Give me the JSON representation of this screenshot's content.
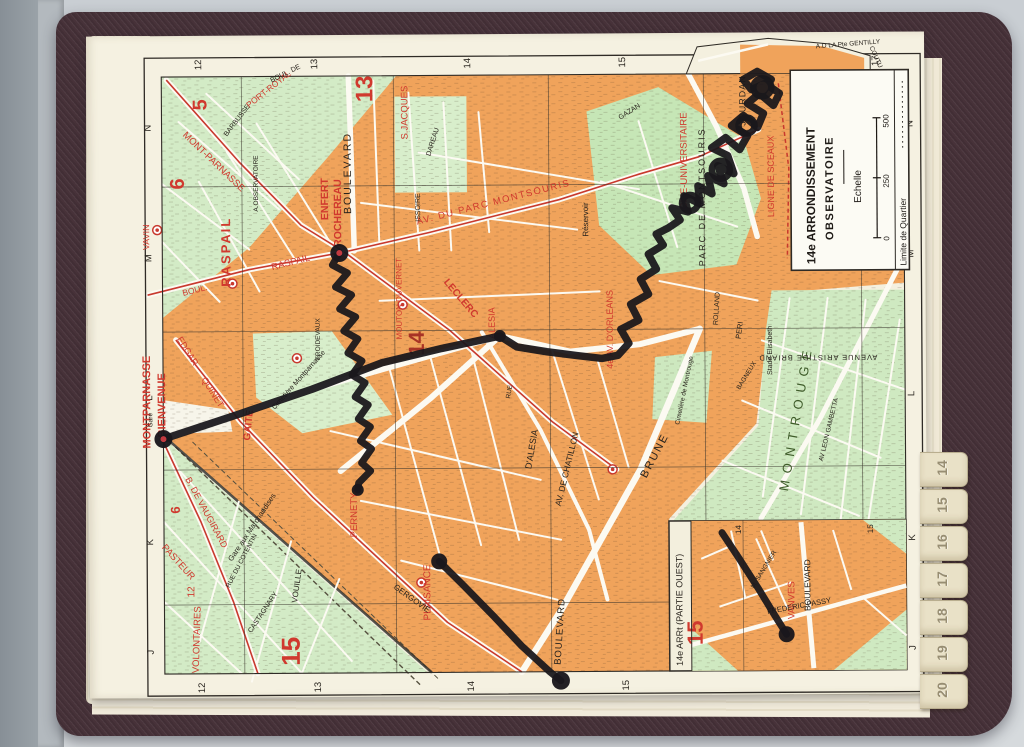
{
  "colors": {
    "accent_red": "#d0392e",
    "block_orange": "#f0a35b",
    "area_green": "#d3ebc6",
    "park_green": "#c6e6b6",
    "route_black": "#1a171c",
    "cover_maroon": "#473239",
    "paper_cream": "#f5f1e1",
    "tab_cream": "#e9e1c7"
  },
  "legend": {
    "l1": "14e ARRONDISSEMENT",
    "l2": "OBSERVATOIRE",
    "echelle": "Echelle",
    "t0": "0",
    "t250": "250",
    "t500": "500",
    "limite": "Limite de Quartier"
  },
  "tabs": [
    "14",
    "15",
    "16",
    "17",
    "18",
    "19",
    "20"
  ],
  "map": {
    "inset_title": "14e ARRt (PARTIE OUEST)",
    "grid": {
      "cols": [
        "12",
        "13",
        "14",
        "15",
        "16",
        "17"
      ],
      "colX": [
        203,
        319,
        472,
        627,
        788,
        880
      ],
      "colLineX": [
        243,
        395,
        550,
        705,
        862
      ],
      "rows": [
        "N",
        "M",
        "L",
        "K",
        "J"
      ],
      "rowY": [
        126,
        256,
        396,
        540,
        650
      ],
      "rowLineY": [
        185,
        330,
        468,
        603
      ],
      "insetCols": [
        "14",
        "15"
      ],
      "insetColX": [
        740,
        872
      ]
    },
    "labels": [
      {
        "t": "MONTPARNASSE",
        "x": 150,
        "y": 400,
        "r": -90,
        "s": 11,
        "c": "r",
        "b": 1
      },
      {
        "t": "-BIENVENUE",
        "x": 165,
        "y": 405,
        "r": -90,
        "s": 11,
        "c": "r",
        "b": 1
      },
      {
        "t": "Gare",
        "x": 152,
        "y": 418,
        "r": -90,
        "s": 6.5,
        "c": "k"
      },
      {
        "t": "VAVIN",
        "x": 150,
        "y": 235,
        "r": -90,
        "s": 9,
        "c": "r"
      },
      {
        "t": "RASPAIL",
        "x": 231,
        "y": 250,
        "r": -90,
        "s": 13,
        "c": "r",
        "b": 1,
        "ls": 2
      },
      {
        "t": "BOUL.",
        "x": 196,
        "y": 291,
        "r": -14,
        "s": 8.5,
        "c": "r"
      },
      {
        "t": "RASPAIL",
        "x": 292,
        "y": 264,
        "r": -14,
        "s": 9.5,
        "c": "r"
      },
      {
        "t": "MONT-PARNASSE",
        "x": 213,
        "y": 162,
        "r": 44,
        "s": 9.5,
        "c": "r"
      },
      {
        "t": "PORT-ROYAL",
        "x": 272,
        "y": 90,
        "r": -38,
        "s": 8.5,
        "c": "r"
      },
      {
        "t": "EDGAR-",
        "x": 186,
        "y": 352,
        "r": 58,
        "s": 9,
        "c": "r"
      },
      {
        "t": "QUINET",
        "x": 210,
        "y": 392,
        "r": 58,
        "s": 9,
        "c": "r"
      },
      {
        "t": "GAITE",
        "x": 251,
        "y": 424,
        "r": -84,
        "s": 10,
        "c": "r",
        "b": 1
      },
      {
        "t": "PERNETY",
        "x": 356,
        "y": 514,
        "r": -90,
        "s": 9.5,
        "c": "r"
      },
      {
        "t": "PLAISANCE",
        "x": 429,
        "y": 592,
        "r": -90,
        "s": 10,
        "c": "r"
      },
      {
        "t": "B. DE VAUGIRARD",
        "x": 203,
        "y": 512,
        "r": 62,
        "s": 9,
        "c": "r"
      },
      {
        "t": "PASTEUR",
        "x": 175,
        "y": 562,
        "r": 48,
        "s": 9.5,
        "c": "r"
      },
      {
        "t": "VOLONTAIRES",
        "x": 198,
        "y": 638,
        "r": -88,
        "s": 9.5,
        "c": "r"
      },
      {
        "t": "12",
        "x": 193,
        "y": 590,
        "r": -90,
        "s": 10,
        "c": "r"
      },
      {
        "t": "ENFERT",
        "x": 329,
        "y": 198,
        "r": -90,
        "s": 10.5,
        "c": "r",
        "b": 1
      },
      {
        "t": "ROCHEREAU",
        "x": 342,
        "y": 212,
        "r": -90,
        "s": 10.5,
        "c": "r",
        "b": 1
      },
      {
        "t": "S.JACQUES",
        "x": 409,
        "y": 112,
        "r": -90,
        "s": 9.5,
        "c": "r"
      },
      {
        "t": "AV. DU PARC MONTSOURIS",
        "x": 495,
        "y": 205,
        "r": -14,
        "s": 9.5,
        "c": "r",
        "ls": 1.5
      },
      {
        "t": "MOUTON DUVERNET",
        "x": 402,
        "y": 298,
        "r": -90,
        "s": 8,
        "c": "r"
      },
      {
        "t": "LECLERC",
        "x": 459,
        "y": 300,
        "r": 50,
        "s": 10,
        "c": "r",
        "b": 1
      },
      {
        "t": "4e AV. D'ORLEANS",
        "x": 613,
        "y": 330,
        "r": -90,
        "s": 9,
        "c": "r"
      },
      {
        "t": "ALESIA",
        "x": 495,
        "y": 323,
        "r": -90,
        "s": 9,
        "c": "r"
      },
      {
        "t": "CITE-UNIVERSITAIRE",
        "x": 688,
        "y": 162,
        "r": -90,
        "s": 9.5,
        "c": "r"
      },
      {
        "t": "LIGNE DE SCEAUX",
        "x": 775,
        "y": 178,
        "r": -90,
        "s": 9,
        "c": "r"
      },
      {
        "t": "VANVES",
        "x": 793,
        "y": 602,
        "r": -90,
        "s": 9.5,
        "c": "r"
      },
      {
        "t": "5",
        "x": 208,
        "y": 103,
        "r": -90,
        "s": 20,
        "c": "r",
        "b": 1
      },
      {
        "t": "6",
        "x": 185,
        "y": 182,
        "r": -90,
        "s": 20,
        "c": "r",
        "b": 1
      },
      {
        "t": "13",
        "x": 374,
        "y": 88,
        "r": -90,
        "s": 24,
        "c": "r",
        "b": 1
      },
      {
        "t": "6",
        "x": 179,
        "y": 508,
        "r": -90,
        "s": 13,
        "c": "r",
        "b": 1
      },
      {
        "t": "15",
        "x": 298,
        "y": 650,
        "r": -90,
        "s": 26,
        "c": "r",
        "b": 1
      },
      {
        "t": "15",
        "x": 701,
        "y": 634,
        "r": -90,
        "s": 22,
        "c": "r",
        "b": 1
      },
      {
        "t": "14",
        "x": 424,
        "y": 343,
        "r": -90,
        "s": 22,
        "c": "dr",
        "b": 1
      },
      {
        "t": "BOULEVARD",
        "x": 352,
        "y": 172,
        "r": -90,
        "s": 10.5,
        "c": "k",
        "ls": 2
      },
      {
        "t": "A.OBSERVATOIRE",
        "x": 259,
        "y": 182,
        "r": -90,
        "s": 6.5,
        "c": "k"
      },
      {
        "t": "BARBUSSE",
        "x": 240,
        "y": 120,
        "r": -52,
        "s": 7,
        "c": "k"
      },
      {
        "t": "ISSOIRE",
        "x": 421,
        "y": 207,
        "r": -90,
        "s": 7,
        "c": "k"
      },
      {
        "t": "DAREAU",
        "x": 436,
        "y": 142,
        "r": -72,
        "s": 7,
        "c": "k"
      },
      {
        "t": "JOURDAN",
        "x": 747,
        "y": 102,
        "r": -90,
        "s": 9,
        "c": "k",
        "ls": 1
      },
      {
        "t": "GAZAN",
        "x": 632,
        "y": 114,
        "r": -32,
        "s": 7,
        "c": "k"
      },
      {
        "t": "PARC DE MONTSOURIS",
        "x": 706,
        "y": 198,
        "r": -90,
        "s": 9,
        "c": "k",
        "ls": 2
      },
      {
        "t": "Réservoir",
        "x": 589,
        "y": 220,
        "r": -90,
        "s": 8,
        "c": "k"
      },
      {
        "t": "RUE",
        "x": 511,
        "y": 392,
        "r": -80,
        "s": 6.5,
        "c": "k"
      },
      {
        "t": "D'ALESIA",
        "x": 534,
        "y": 450,
        "r": -80,
        "s": 9,
        "c": "k"
      },
      {
        "t": "AV. DE CHATILLON",
        "x": 569,
        "y": 470,
        "r": -76,
        "s": 8.5,
        "c": "k"
      },
      {
        "t": "BRUNE",
        "x": 657,
        "y": 458,
        "r": -62,
        "s": 11,
        "c": "k",
        "ls": 2
      },
      {
        "t": "BOULEVARD",
        "x": 561,
        "y": 632,
        "r": -86,
        "s": 9.5,
        "c": "k",
        "ls": 1
      },
      {
        "t": "GERGOVIE",
        "x": 409,
        "y": 600,
        "r": 36,
        "s": 8,
        "c": "k"
      },
      {
        "t": "VOUILLE",
        "x": 298,
        "y": 585,
        "r": -82,
        "s": 8,
        "c": "k"
      },
      {
        "t": "CASTAGNARY",
        "x": 263,
        "y": 612,
        "r": -56,
        "s": 7,
        "c": "k"
      },
      {
        "t": "Gare aux Marchandises",
        "x": 253,
        "y": 527,
        "r": -56,
        "s": 7.5,
        "c": "k"
      },
      {
        "t": "RUE DU COTENTIN",
        "x": 242,
        "y": 560,
        "r": -62,
        "s": 6.5,
        "c": "k"
      },
      {
        "t": "FREDERIC PASSY",
        "x": 798,
        "y": 610,
        "r": -10,
        "s": 7.5,
        "c": "k"
      },
      {
        "t": "M. SANGNIER",
        "x": 764,
        "y": 572,
        "r": -58,
        "s": 6.5,
        "c": "k"
      },
      {
        "t": "A.D LA Pte GENTILLY",
        "x": 850,
        "y": 48,
        "r": -4,
        "s": 6.5,
        "c": "k"
      },
      {
        "t": "COUTU",
        "x": 876,
        "y": 60,
        "r": 66,
        "s": 6.5,
        "c": "k"
      },
      {
        "t": "Stade Elisabeth",
        "x": 772,
        "y": 352,
        "r": -90,
        "s": 7,
        "c": "k"
      },
      {
        "t": "Cimetière de Montrouge",
        "x": 686,
        "y": 392,
        "r": -78,
        "s": 6.5,
        "c": "k"
      },
      {
        "t": "Cimetière Montparnasse",
        "x": 300,
        "y": 380,
        "r": -48,
        "s": 7,
        "c": "k"
      },
      {
        "t": "FROIDEVAUX",
        "x": 320,
        "y": 338,
        "r": -90,
        "s": 6.5,
        "c": "k"
      },
      {
        "t": "BOULEVARD",
        "x": 809,
        "y": 587,
        "r": -90,
        "s": 8.5,
        "c": "k"
      },
      {
        "t": "MONTROUGE",
        "x": 800,
        "y": 420,
        "r": -80,
        "s": 13,
        "c": "g",
        "ls": 7
      },
      {
        "t": "AVENUE ARISTIDE BRIAND",
        "x": 818,
        "y": 357,
        "r": 180,
        "s": 7.5,
        "c": "k",
        "ls": 1
      },
      {
        "t": "PERI",
        "x": 742,
        "y": 332,
        "r": -82,
        "s": 7.5,
        "c": "k"
      },
      {
        "t": "AV LEON GAMBETTA",
        "x": 830,
        "y": 432,
        "r": -76,
        "s": 6.5,
        "c": "k"
      },
      {
        "t": "ROLLAND",
        "x": 719,
        "y": 310,
        "r": -86,
        "s": 7,
        "c": "k"
      },
      {
        "t": "BAGNEUX",
        "x": 748,
        "y": 378,
        "r": -58,
        "s": 6.5,
        "c": "k"
      },
      {
        "t": "BOUL. DE",
        "x": 288,
        "y": 74,
        "r": -26,
        "s": 7,
        "c": "k"
      },
      {
        "t": "14",
        "x": 740,
        "y": 531,
        "r": -90,
        "s": 8,
        "c": "k"
      },
      {
        "t": "15",
        "x": 872,
        "y": 531,
        "r": -90,
        "s": 8,
        "c": "k"
      }
    ],
    "route": {
      "color": "#1a171c",
      "main": [
        [
          163,
          437
        ],
        [
          240,
          412
        ],
        [
          312,
          388
        ],
        [
          382,
          362
        ],
        [
          442,
          348
        ],
        [
          500,
          336
        ],
        [
          517,
          347
        ],
        [
          547,
          352
        ],
        [
          577,
          356
        ],
        [
          602,
          359
        ],
        [
          618,
          356
        ],
        [
          629,
          344
        ],
        [
          621,
          330
        ],
        [
          639,
          321
        ],
        [
          631,
          305
        ],
        [
          649,
          295
        ],
        [
          641,
          280
        ],
        [
          657,
          270
        ],
        [
          649,
          255
        ],
        [
          664,
          246
        ],
        [
          657,
          235
        ],
        [
          669,
          229
        ],
        [
          681,
          221
        ],
        [
          673,
          209
        ],
        [
          689,
          213
        ],
        [
          685,
          197
        ],
        [
          701,
          205
        ],
        [
          699,
          187
        ],
        [
          713,
          195
        ],
        [
          709,
          177
        ],
        [
          725,
          185
        ],
        [
          719,
          167
        ],
        [
          735,
          175
        ],
        [
          729,
          157
        ],
        [
          713,
          149
        ],
        [
          727,
          139
        ],
        [
          741,
          151
        ],
        [
          749,
          137
        ],
        [
          733,
          127
        ],
        [
          745,
          117
        ],
        [
          759,
          129
        ],
        [
          765,
          115
        ],
        [
          749,
          105
        ],
        [
          761,
          95
        ],
        [
          775,
          107
        ],
        [
          781,
          95
        ],
        [
          767,
          85
        ],
        [
          753,
          91
        ],
        [
          745,
          81
        ],
        [
          759,
          73
        ],
        [
          773,
          81
        ],
        [
          765,
          93
        ]
      ],
      "loops": [
        [
          691,
          204,
          8
        ],
        [
          722,
          171,
          9
        ],
        [
          748,
          127,
          8
        ],
        [
          764,
          89,
          9
        ]
      ],
      "descent": [
        [
          340,
          252
        ],
        [
          333,
          264
        ],
        [
          348,
          272
        ],
        [
          336,
          286
        ],
        [
          352,
          294
        ],
        [
          340,
          308
        ],
        [
          356,
          316
        ],
        [
          344,
          330
        ],
        [
          358,
          338
        ],
        [
          348,
          352
        ],
        [
          362,
          360
        ],
        [
          352,
          374
        ],
        [
          365,
          382
        ],
        [
          355,
          396
        ],
        [
          368,
          404
        ],
        [
          358,
          418
        ],
        [
          370,
          426
        ],
        [
          360,
          440
        ],
        [
          371,
          448
        ],
        [
          361,
          462
        ],
        [
          370,
          470
        ],
        [
          358,
          482
        ],
        [
          357,
          489
        ]
      ],
      "south": [
        [
          438,
          561
        ],
        [
          462,
          585
        ],
        [
          492,
          616
        ],
        [
          520,
          646
        ],
        [
          548,
          672
        ],
        [
          559,
          681
        ]
      ],
      "inset": [
        [
          721,
          534
        ],
        [
          738,
          560
        ],
        [
          757,
          590
        ],
        [
          772,
          615
        ],
        [
          785,
          636
        ]
      ],
      "dots": [
        [
          163,
          437,
          9,
          1
        ],
        [
          340,
          252,
          9,
          1
        ],
        [
          357,
          489,
          6,
          0
        ],
        [
          438,
          561,
          8,
          0
        ],
        [
          559,
          681,
          9,
          0
        ],
        [
          785,
          636,
          8,
          0
        ],
        [
          500,
          336,
          6,
          0
        ]
      ]
    },
    "metro_stations": [
      [
        233,
        282
      ],
      [
        158,
        228
      ],
      [
        297,
        357
      ],
      [
        403,
        304
      ],
      [
        612,
        470
      ],
      [
        420,
        582
      ]
    ]
  }
}
